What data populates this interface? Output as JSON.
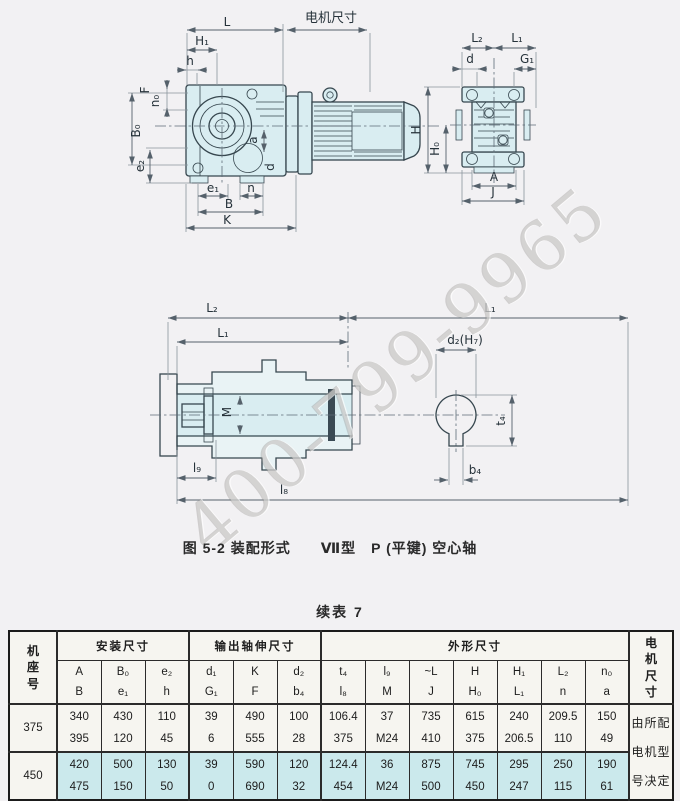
{
  "page": {
    "caption": "图 5-2 装配形式　　Ⅶ型　P (平键) 空心轴",
    "table_title": "续表 7",
    "watermark": "400-799-9965"
  },
  "drawing": {
    "side": {
      "L": "L",
      "motor": "电机尺寸",
      "H1": "H₁",
      "h": "h",
      "F": "F",
      "n0": "n₀",
      "B0": "B₀",
      "e2": "e₂",
      "a": "a",
      "d": "d",
      "e1": "e₁",
      "n": "n",
      "B": "B",
      "K": "K"
    },
    "front": {
      "L2": "L₂",
      "L1": "L₁",
      "d": "d",
      "G1": "G₁",
      "H": "H",
      "H0": "H₀",
      "A": "A",
      "J": "J"
    },
    "sect": {
      "L2": "L₂",
      "L1_top": "L₁",
      "L1_inner": "L₁",
      "M": "M",
      "l9": "l₉",
      "l8": "l₈"
    },
    "detail": {
      "d2": "d₂(H₇)",
      "t4": "t₄",
      "b4": "b₄"
    }
  },
  "table": {
    "frame_chars": [
      "机",
      "座",
      "号"
    ],
    "motor_chars": [
      "电",
      "机",
      "尺",
      "寸"
    ],
    "groups": {
      "install": "安装尺寸",
      "output": "输出轴伸尺寸",
      "overall": "外形尺寸"
    },
    "sym_cols": [
      {
        "top": "A",
        "bot": "B"
      },
      {
        "top": "B₀",
        "bot": "e₁"
      },
      {
        "top": "e₂",
        "bot": "h"
      },
      {
        "top": "d₁",
        "bot": "G₁"
      },
      {
        "top": "K",
        "bot": "F"
      },
      {
        "top": "d₂",
        "bot": "b₄"
      },
      {
        "top": "t₄",
        "bot": "l₈"
      },
      {
        "top": "l₉",
        "bot": "M"
      },
      {
        "top": "~L",
        "bot": "J"
      },
      {
        "top": "H",
        "bot": "H₀"
      },
      {
        "top": "H₁",
        "bot": "L₁"
      },
      {
        "top": "L₂",
        "bot": "n"
      },
      {
        "top": "n₀",
        "bot": "a"
      }
    ],
    "rows": [
      {
        "frame": "375",
        "cells": [
          [
            "340",
            "395"
          ],
          [
            "430",
            "120"
          ],
          [
            "110",
            "45"
          ],
          [
            "39",
            "6"
          ],
          [
            "490",
            "555"
          ],
          [
            "100",
            "28"
          ],
          [
            "106.4",
            "375"
          ],
          [
            "37",
            "M24"
          ],
          [
            "735",
            "410"
          ],
          [
            "615",
            "375"
          ],
          [
            "240",
            "206.5"
          ],
          [
            "209.5",
            "110"
          ],
          [
            "150",
            "49"
          ]
        ]
      },
      {
        "frame": "450",
        "cells": [
          [
            "420",
            "475"
          ],
          [
            "500",
            "150"
          ],
          [
            "130",
            "50"
          ],
          [
            "39",
            "0"
          ],
          [
            "590",
            "690"
          ],
          [
            "120",
            "32"
          ],
          [
            "124.4",
            "454"
          ],
          [
            "36",
            "M24"
          ],
          [
            "875",
            "500"
          ],
          [
            "745",
            "450"
          ],
          [
            "295",
            "247"
          ],
          [
            "250",
            "115"
          ],
          [
            "190",
            "61"
          ]
        ]
      }
    ],
    "motor_note": [
      "由所配",
      "电机型",
      "号决定"
    ]
  },
  "colors": {
    "paper": "#f2f1f3",
    "drawing_fill": "#d9edf1",
    "line": "#37474f",
    "row450": "#cbe9ec",
    "table_bg": "#f6f5f0",
    "border": "#1b1b1b"
  }
}
